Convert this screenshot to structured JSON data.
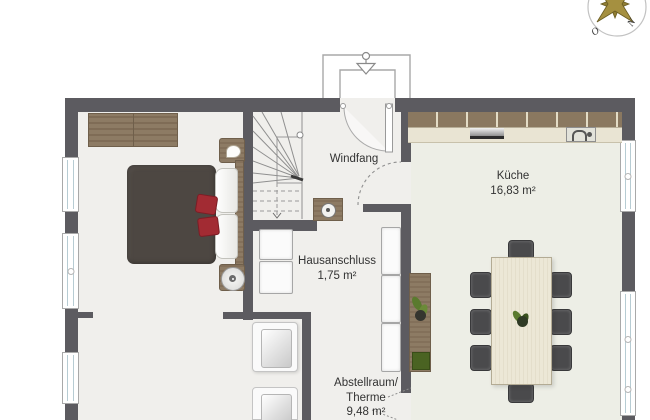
{
  "compass": {
    "letter_west": "O",
    "letter_north": "N"
  },
  "rooms": {
    "windfang": {
      "label": "Windfang"
    },
    "kueche": {
      "label": "Küche",
      "area": "16,83 m²"
    },
    "hausanschluss": {
      "label": "Hausanschluss",
      "area": "1,75 m²"
    },
    "abstellraum": {
      "label_line1": "Abstellraum/",
      "label_line2": "Therme",
      "area": "9,48 m²"
    }
  },
  "colors": {
    "wall": "#5c5b60",
    "floor": "#f0efec",
    "kitchen_floor": "#edeee6",
    "wood": "#8d7b64",
    "counter": "#e9e4d3",
    "cabinet_brown": "#8a7860",
    "bed_duvet": "#4d4742",
    "accent_red": "#a22b33",
    "chair_dark": "#4a4a4c",
    "compass_gold": "#a59040",
    "plant_green": "#5a7a2e"
  }
}
